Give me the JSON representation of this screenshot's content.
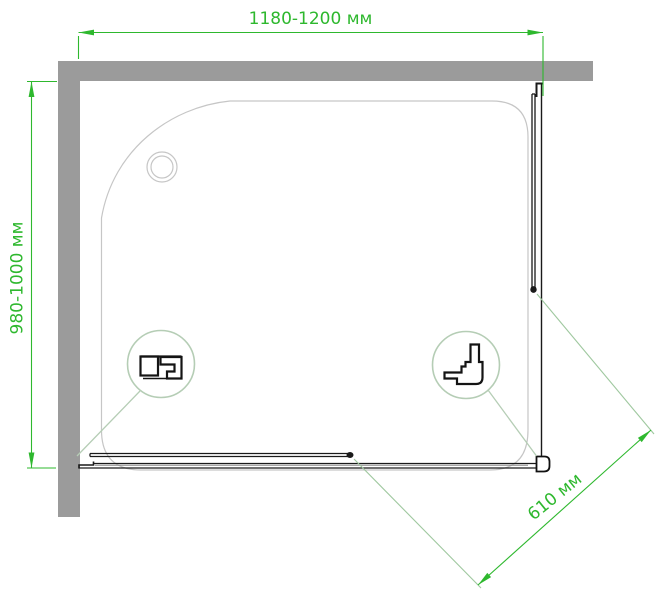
{
  "dimensions": {
    "top_width": {
      "label": "1180-1200 мм"
    },
    "left_depth": {
      "label": "980-1000 мм"
    },
    "diagonal_opening": {
      "label": "610 мм"
    }
  },
  "colors": {
    "dimension_green": "#2eb82e",
    "callout_pale_green": "#b5cdb5",
    "wall_gray": "#9b9b9b",
    "tray_gray": "#c6c6c6",
    "profile_black": "#1a1a1a"
  }
}
